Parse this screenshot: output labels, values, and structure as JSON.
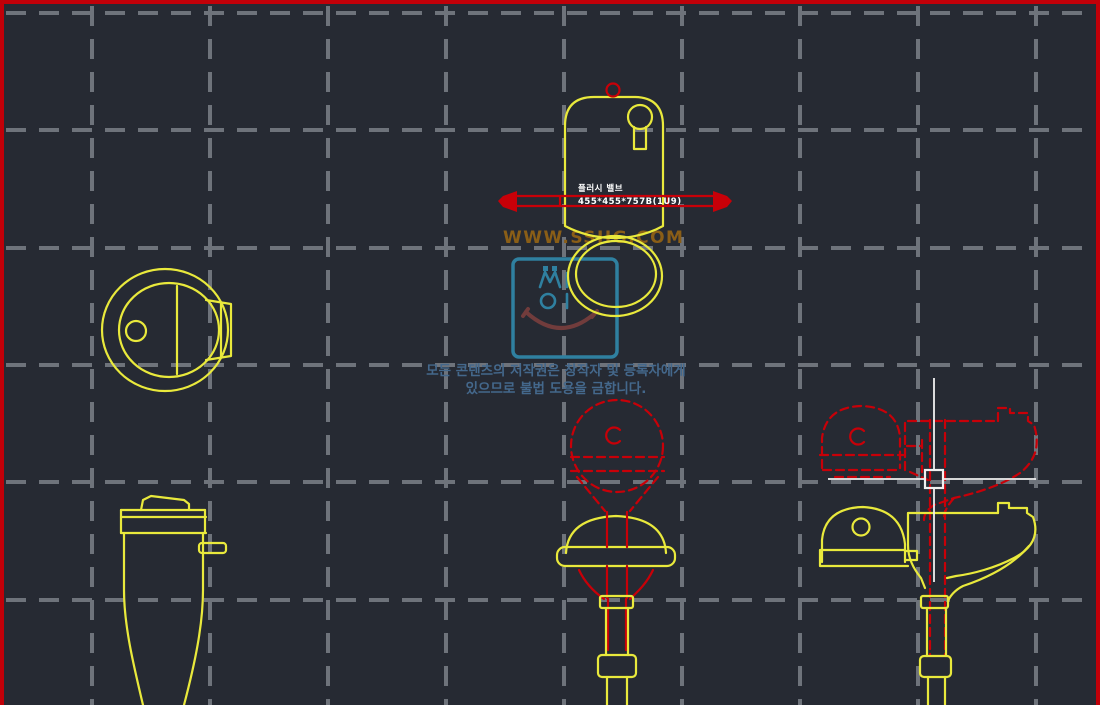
{
  "texts": {
    "watermark_url": "WWW.SSIIG.COM",
    "copyright_line1": "모든 콘텐츠의 저작권은 창작자 및 등록자에게",
    "copyright_line2": "있으므로 불법 도용을 금합니다.",
    "block_label_line1": "플러시 밸브",
    "block_label_line2": "455*455*757B(1U9)"
  },
  "colors": {
    "background": "#262a33",
    "border": "#c10008",
    "grid": "#6e737b",
    "line_yellow": "#e9e93c",
    "line_red": "#c80008",
    "crosshair": "#f0f0f0",
    "label_text": "#ffffff",
    "watermark_text": "#8a5e17",
    "logo_teal": "#2f80a0",
    "logo_smile": "#713c3c",
    "copyright_text": "#44688c"
  }
}
